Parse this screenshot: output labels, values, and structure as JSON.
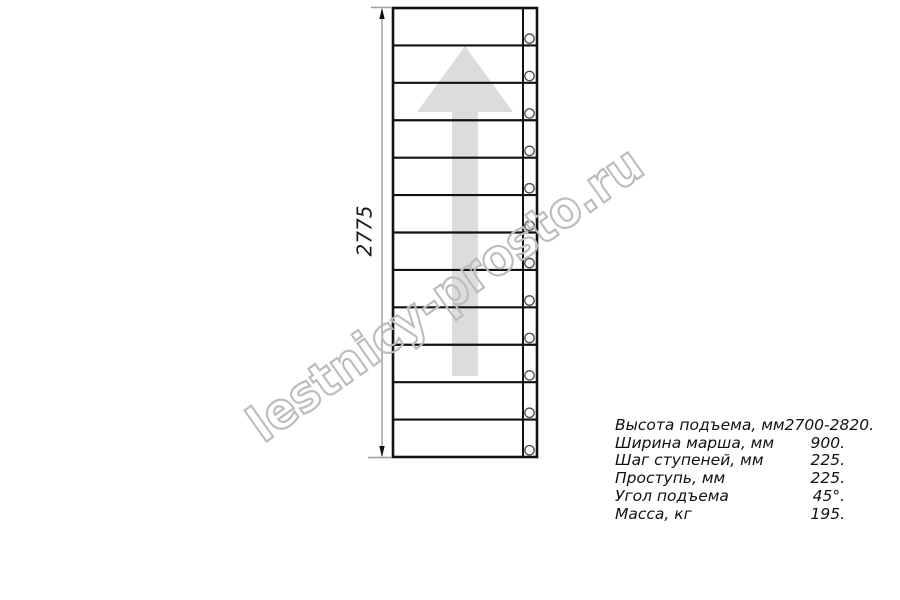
{
  "colors": {
    "background": "#ffffff",
    "line": "#111111",
    "arrow": "#dcdcdc",
    "dimension": "#9c9c9c",
    "watermark": "#bcbcbc",
    "text": "#111111"
  },
  "watermark": {
    "text": "lestnicy-prosto.ru"
  },
  "drawing": {
    "dimension_label": "2775",
    "steps": 12,
    "frame": {
      "x": 393,
      "y": 8,
      "width": 144,
      "height": 449
    },
    "stringer_x": 523,
    "hole": {
      "cx": 529.5,
      "r": 4.7,
      "offset_above_line": 6.8
    }
  },
  "specs": {
    "rows": [
      {
        "label": "Высота подъема, мм",
        "value": "2700-2820."
      },
      {
        "label": "Ширина марша, мм",
        "value": "900."
      },
      {
        "label": "Шаг ступеней, мм",
        "value": "225."
      },
      {
        "label": "Проступь, мм",
        "value": "225."
      },
      {
        "label": "Угол подъема",
        "value": "45°."
      },
      {
        "label": "Масса, кг",
        "value": "195."
      }
    ]
  }
}
